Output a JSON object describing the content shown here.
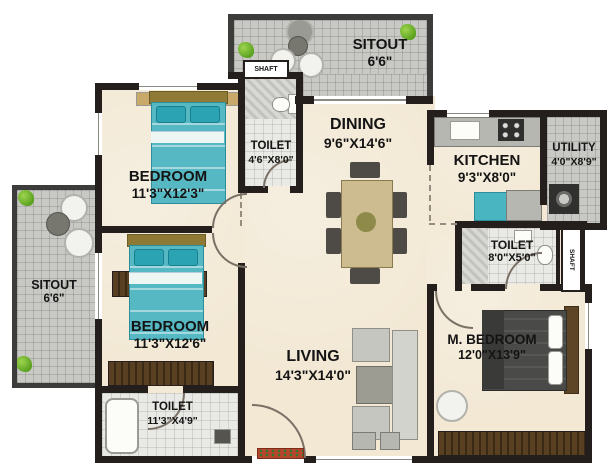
{
  "rooms": {
    "sitout_top": {
      "name": "SITOUT",
      "dims": "6'6\""
    },
    "bedroom1": {
      "name": "BEDROOM",
      "dims": "11'3\"X12'3\""
    },
    "toilet1": {
      "name": "TOILET",
      "dims": "4'6\"X8'0\""
    },
    "dining": {
      "name": "DINING",
      "dims": "9'6\"X14'6\""
    },
    "kitchen": {
      "name": "KITCHEN",
      "dims": "9'3\"X8'0\""
    },
    "utility": {
      "name": "UTILITY",
      "dims": "4'0\"X8'9\""
    },
    "toilet2": {
      "name": "TOILET",
      "dims": "8'0\"X5'0\""
    },
    "sitout_left": {
      "name": "SITOUT",
      "dims": "6'6\""
    },
    "bedroom2": {
      "name": "BEDROOM",
      "dims": "11'3\"X12'6\""
    },
    "toilet3": {
      "name": "TOILET",
      "dims": "11'3\"X4'9\""
    },
    "living": {
      "name": "LIVING",
      "dims": "14'3\"X14'0\""
    },
    "m_bedroom": {
      "name": "M. BEDROOM",
      "dims": "12'0\"X13'9\""
    }
  },
  "shafts": {
    "top": {
      "label": "SHAFT"
    },
    "right": {
      "label": "SHAFT"
    }
  },
  "colors": {
    "wall": "#241f1c",
    "floor": "#f2e8d4",
    "sitout_tile": "#c8c8c4",
    "toilet_tile": "#e9e9e5",
    "bed_teal": "#55b8c3",
    "master_bed": "#4a4a48",
    "wardrobe_wood": "#4a3319",
    "plant_green": "#6fb32b",
    "doormat_red": "#b8442b"
  }
}
